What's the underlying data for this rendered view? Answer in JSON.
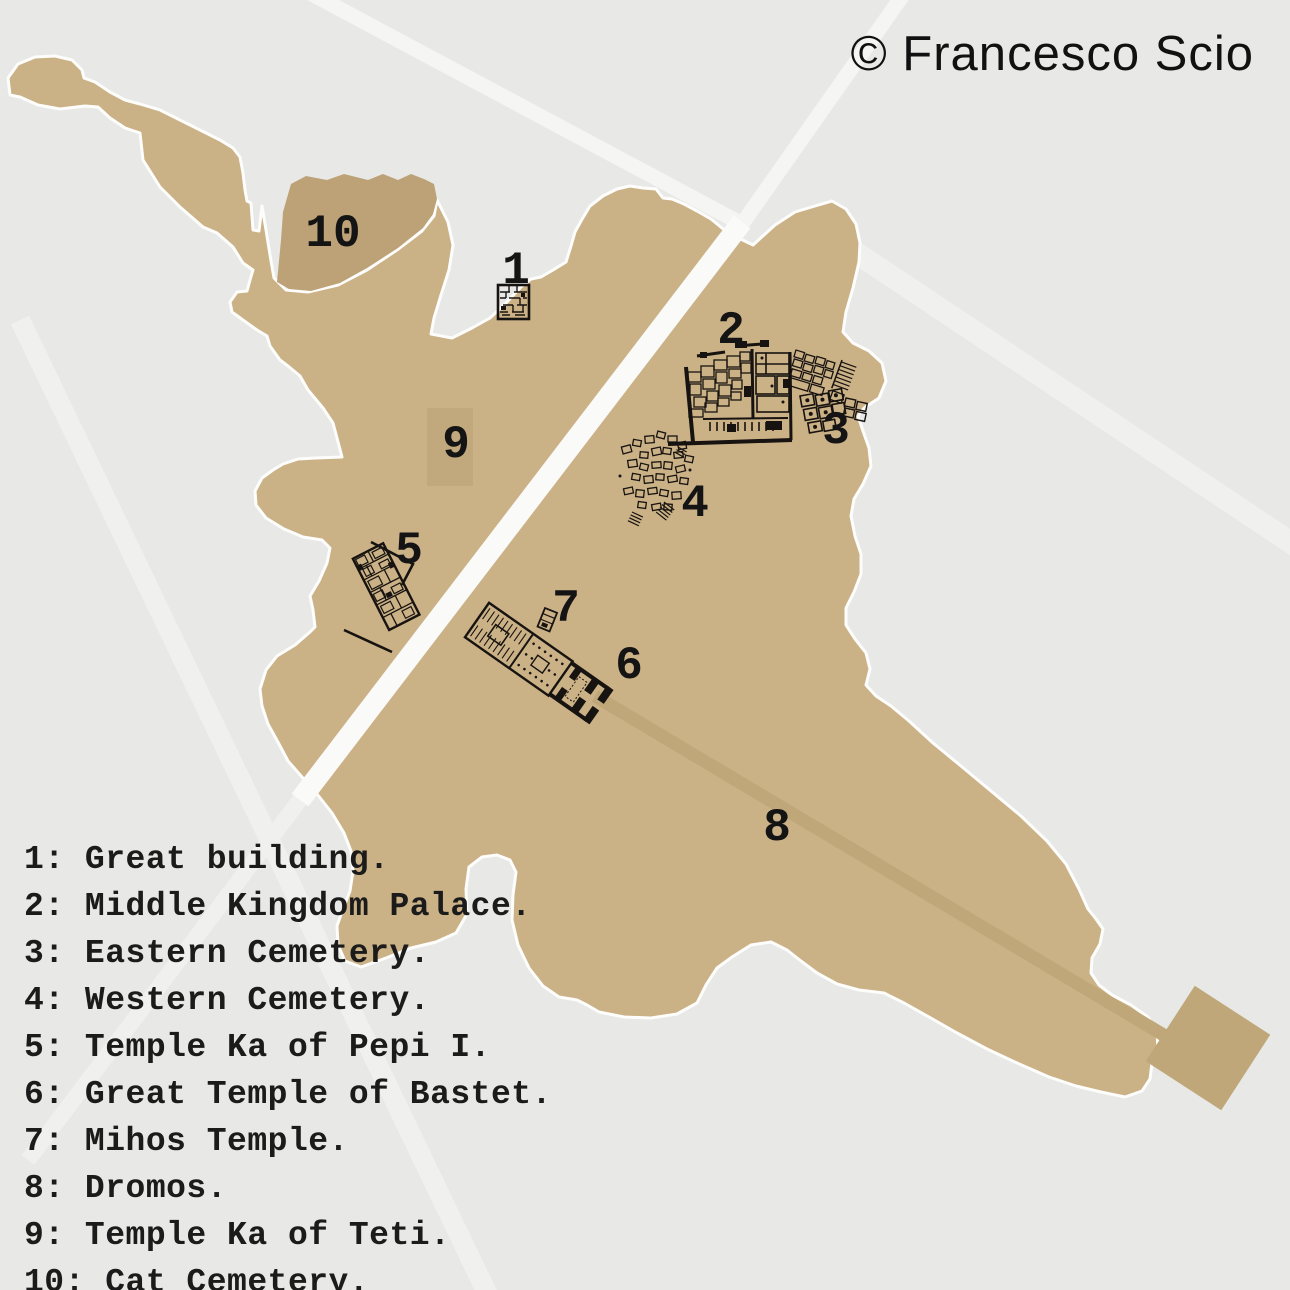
{
  "copyright": "© Francesco Scio",
  "map_labels": {
    "l1": "1",
    "l2": "2",
    "l3": "3",
    "l4": "4",
    "l5": "5",
    "l6": "6",
    "l7": "7",
    "l8": "8",
    "l9": "9",
    "l10": "10"
  },
  "legend": {
    "lines": [
      "1: Great building.",
      "2: Middle Kingdom Palace.",
      "3: Eastern Cemetery.",
      "4: Western Cemetery.",
      "5: Temple Ka of Pepi I.",
      "6: Great Temple of Bastet.",
      "7: Mihos Temple.",
      "8: Dromos.",
      "9: Temple Ka of Teti.",
      "10: Cat Cemetery."
    ]
  },
  "colors": {
    "background": "#e8e8e6",
    "land": "#cbb186",
    "land-dark": "#bca276",
    "land-mid": "#c2a97d",
    "dromos": "#bfa779",
    "road-bright": "#fafaf8",
    "road-faint": "#f0f0ee",
    "ink": "#171310",
    "text": "#141414"
  }
}
